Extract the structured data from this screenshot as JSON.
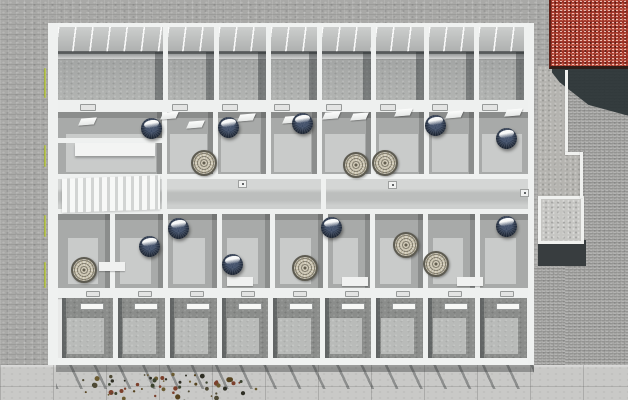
{
  "meta": {
    "title": "Aerial top-down 3D architectural render",
    "subject": "Rectangular multi-unit building shown dollhouse-style (roof removed) with a top and bottom row of glass-railed balconies, a central corridor, exposed furnished rooms, surrounded by gray paver ground, a red gravel roof at top right, a concrete pad, and tree branches at bottom left",
    "visible_text": []
  },
  "palette": {
    "paver": "#a9a9a7",
    "paver_fine": "#a5a5a3",
    "slab": "#c9c9c7",
    "wall_white": "#eff1f0",
    "room_floor_dark": "#a8aaa9",
    "room_floor_light": "#c9cbca",
    "corridor_floor": "#c8cac9",
    "balcony_glass": "#c6c8c7",
    "balcony_floor_top": "#aaacaa",
    "balcony_floor_bottom": "#8b8d8b",
    "balcony_floor_bottom_light": "#b9bbb9",
    "shadow_dark": "#2b3436",
    "red_roof": "#9c3226",
    "pad_concrete": "#c6c6c3",
    "pendant_lamp": "#1d2634",
    "round_rug": "#c6bfa9",
    "plant_green": "#aab648"
  },
  "canvas": {
    "width": 628,
    "height": 400
  },
  "ground": {
    "slab_strip": {
      "x": 0,
      "y": 365,
      "w": 628,
      "h": 35
    },
    "slab_joint_y": 386,
    "fine_paver_regions": [
      {
        "x": 565,
        "y": 60,
        "w": 63,
        "h": 306
      },
      {
        "x": 534,
        "y": 266,
        "w": 31,
        "h": 99
      }
    ]
  },
  "surroundings": {
    "red_roof": {
      "x": 549,
      "y": 0,
      "w": 79,
      "h": 66
    },
    "roof_shadow": {
      "x": 552,
      "y": 66,
      "w": 76,
      "h": 54
    },
    "sandy_strips": [
      {
        "x": 538,
        "y": 66,
        "w": 27,
        "h": 89
      },
      {
        "x": 538,
        "y": 155,
        "w": 45,
        "h": 41
      }
    ],
    "curbs": [
      {
        "x": 565,
        "y": 70,
        "w": 3,
        "h": 85
      },
      {
        "x": 565,
        "y": 152,
        "w": 18,
        "h": 3
      },
      {
        "x": 580,
        "y": 152,
        "w": 3,
        "h": 46
      }
    ],
    "concrete_pad": {
      "x": 538,
      "y": 196,
      "w": 40,
      "h": 42
    },
    "pad_shadow": {
      "x": 538,
      "y": 240,
      "w": 48,
      "h": 26
    }
  },
  "building": {
    "x": 48,
    "y": 23,
    "w": 486,
    "h": 342,
    "interior_left": 58,
    "interior_right": 528,
    "rows": {
      "top_balcony": [
        23,
        100
      ],
      "top_wall_band": [
        100,
        112
      ],
      "upper_rooms": [
        112,
        174
      ],
      "corridor": [
        174,
        214
      ],
      "lower_rooms": [
        214,
        288
      ],
      "bottom_wall_band": [
        288,
        298
      ],
      "bottom_balcony": [
        298,
        358
      ],
      "bottom_rail": [
        358,
        365
      ]
    },
    "top_balcony_bounds": [
      58,
      163,
      214,
      266,
      317,
      371,
      424,
      474,
      524
    ],
    "bottom_balcony_bounds": [
      62,
      113,
      165,
      217,
      268,
      320,
      371,
      423,
      475,
      527
    ],
    "upper_room_bounds": [
      58,
      162,
      213,
      266,
      317,
      371,
      424,
      474,
      528
    ],
    "lower_room_bounds": [
      58,
      110,
      163,
      217,
      270,
      323,
      370,
      423,
      475,
      528
    ],
    "corridor_dividers": [
      162,
      321
    ],
    "left_section": {
      "upper_wall_y": 138,
      "bench": [
        75,
        143,
        80,
        13
      ],
      "stair_patch": [
        62,
        177,
        98,
        34
      ],
      "lower_wall": [
        58,
        250,
        52,
        5
      ]
    }
  },
  "objects": {
    "pendant_lamps": [
      [
        152,
        129
      ],
      [
        229,
        128
      ],
      [
        303,
        124
      ],
      [
        436,
        126
      ],
      [
        507,
        139
      ],
      [
        179,
        229
      ],
      [
        150,
        247
      ],
      [
        332,
        228
      ],
      [
        507,
        227
      ],
      [
        233,
        265
      ]
    ],
    "round_rugs": [
      [
        202,
        161
      ],
      [
        354,
        163
      ],
      [
        383,
        161
      ],
      [
        82,
        268
      ],
      [
        404,
        243
      ],
      [
        434,
        262
      ],
      [
        303,
        266
      ]
    ],
    "skylights": [
      [
        88,
        121
      ],
      [
        170,
        115
      ],
      [
        196,
        124
      ],
      [
        247,
        117
      ],
      [
        292,
        119
      ],
      [
        332,
        115
      ],
      [
        360,
        116
      ],
      [
        404,
        112
      ],
      [
        455,
        114
      ],
      [
        514,
        112
      ]
    ],
    "floor_mats": [
      [
        112,
        266
      ],
      [
        240,
        281
      ],
      [
        355,
        281
      ],
      [
        470,
        281
      ]
    ],
    "door_dots": [
      [
        238,
        180
      ],
      [
        388,
        181
      ],
      [
        520,
        189
      ]
    ],
    "window_slits_top": [
      [
        80,
        104
      ],
      [
        172,
        104
      ],
      [
        222,
        104
      ],
      [
        274,
        104
      ],
      [
        326,
        104
      ],
      [
        380,
        104
      ],
      [
        432,
        104
      ],
      [
        482,
        104
      ]
    ],
    "window_slits_bottom": [
      [
        86,
        291
      ],
      [
        138,
        291
      ],
      [
        190,
        291
      ],
      [
        241,
        291
      ],
      [
        293,
        291
      ],
      [
        345,
        291
      ],
      [
        396,
        291
      ],
      [
        448,
        291
      ],
      [
        500,
        291
      ]
    ],
    "balcony_slit": {
      "dy": 5,
      "w": 22,
      "h": 5
    }
  },
  "vegetation": {
    "wall_plants": [
      [
        44,
        68,
        2,
        30
      ],
      [
        44,
        145,
        2,
        22
      ],
      [
        44,
        215,
        2,
        22
      ],
      [
        44,
        262,
        2,
        26
      ]
    ],
    "tree": {
      "cx": 160,
      "cy": 389,
      "rx": 100,
      "ry": 15,
      "count": 64,
      "colors": [
        "#4f4a35",
        "#6b5b31",
        "#3c4430",
        "#7c402c",
        "#2e2e24",
        "#56431f"
      ]
    }
  }
}
